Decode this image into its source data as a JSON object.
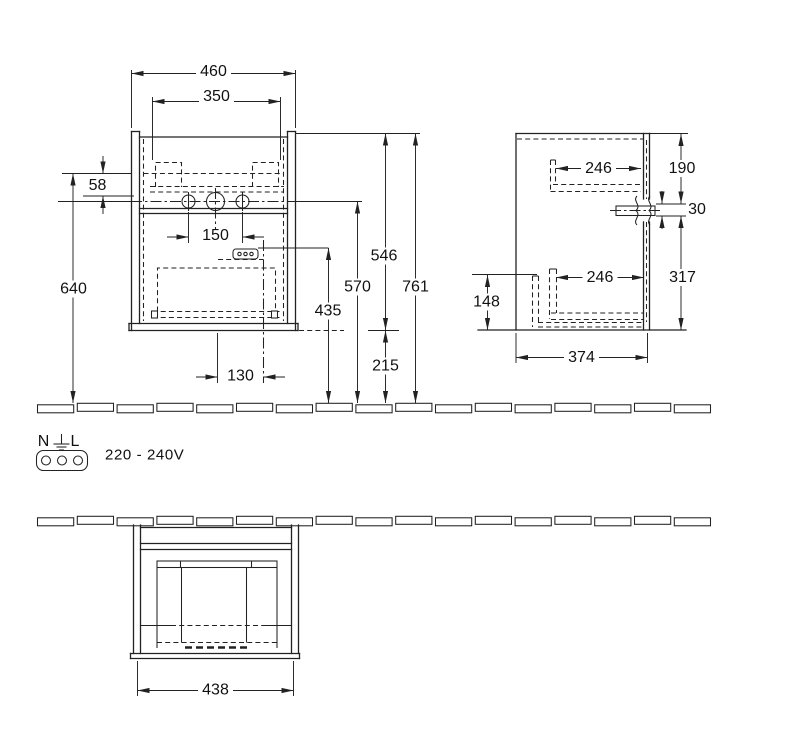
{
  "drawing_title": "vanity-unit-dimension-drawing",
  "colors": {
    "line": "#222222",
    "background": "#ffffff"
  },
  "front_view": {
    "dims": {
      "width_overall": "460",
      "width_fixing": "350",
      "fixing_offset": "58",
      "fixing_height_to_floor": "640",
      "tap_hole_spacing": "150",
      "socket_offset": "130",
      "socket_height": "435",
      "tap_hole_height": "570",
      "cabinet_height": "546",
      "overall_height": "761",
      "floor_clearance": "215"
    }
  },
  "side_view": {
    "dims": {
      "rail_top_length": "246",
      "top_offset": "190",
      "tab_thickness": "30",
      "lower_offset": "317",
      "rail_height": "148",
      "rail_bottom_length": "246",
      "depth": "374"
    }
  },
  "bottom_view": {
    "dims": {
      "width": "438"
    }
  },
  "electrical": {
    "neutral_label": "N",
    "line_label": "L",
    "voltage": "220 - 240V"
  }
}
